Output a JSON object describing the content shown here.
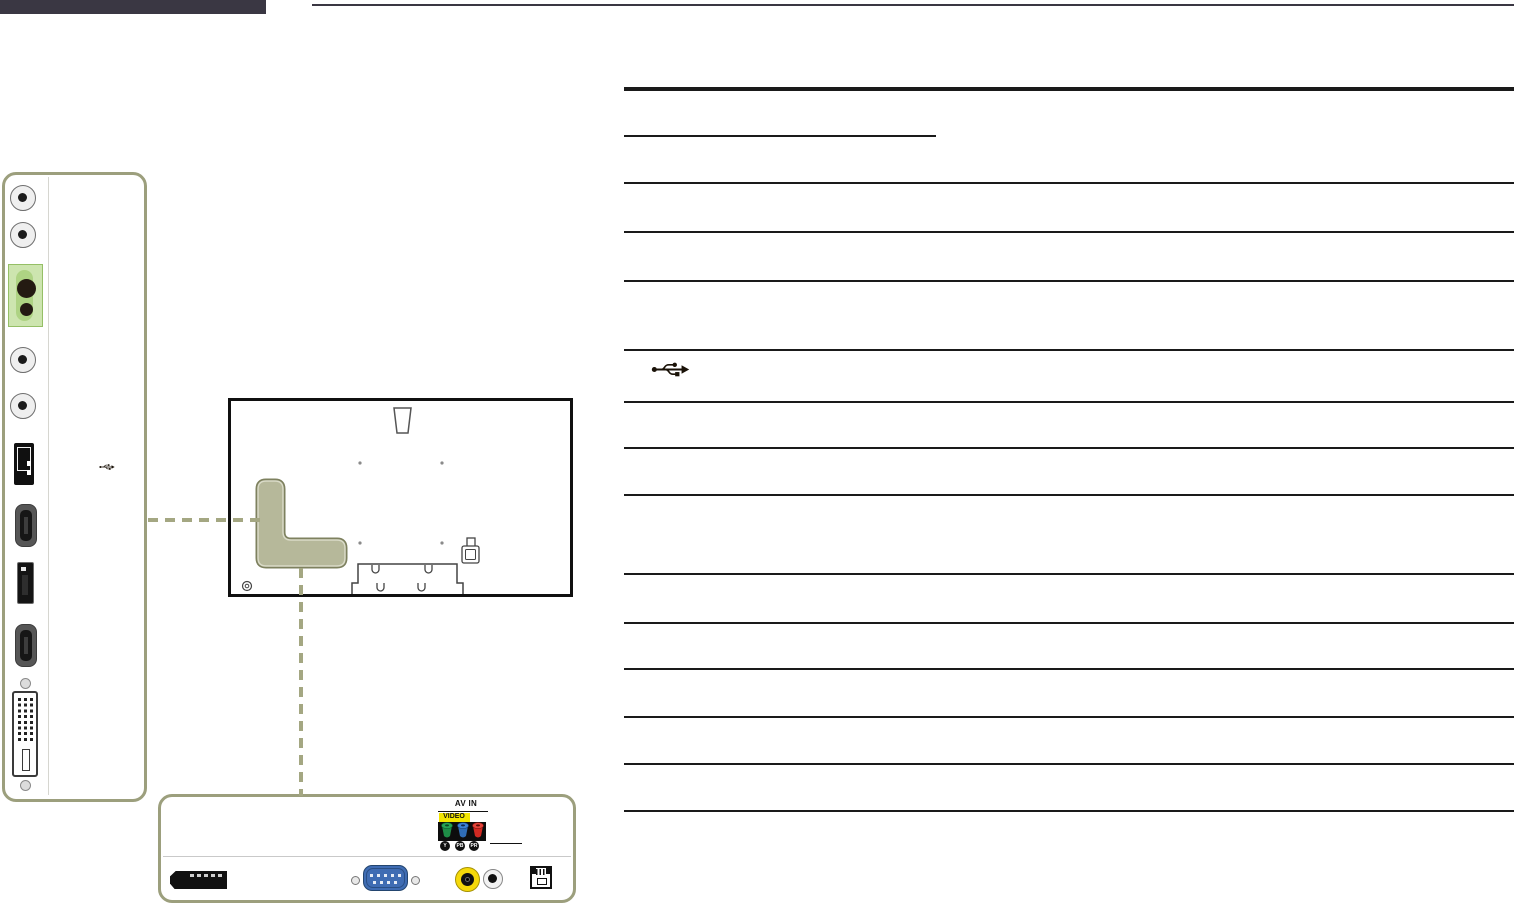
{
  "header": {
    "bar_color": "#3a3743",
    "rule_color": "#3a3743"
  },
  "rear_panel": {
    "outline_color": "#9c9f7d",
    "ports_top_to_bottom": [
      "audio-jack",
      "audio-jack",
      "green-highlight-audio-jacks",
      "audio-jack",
      "audio-jack",
      "usb-port",
      "hdmi-port",
      "displayport",
      "hdmi-port",
      "dvi-port"
    ],
    "highlight_green": {
      "border": "#95bf66",
      "fill": "#cde5af",
      "pill": "#aed383"
    },
    "usb_symbol": "usb-icon"
  },
  "display_back": {
    "outline_color": "#101010",
    "port_area_fill": "#b6b89a",
    "port_area_border": "#7e815f",
    "features": [
      "handle",
      "vesa-holes",
      "port-area-highlight",
      "power-connector",
      "stand-bracket",
      "kensington-lock-slot"
    ]
  },
  "callout": {
    "dash_color": "#a4a782"
  },
  "bottom_panel": {
    "outline_color": "#9c9f7d",
    "av_in_label": "AV IN",
    "video_label": "VIDEO",
    "video_label_bg": "#f2e500",
    "component_labels": [
      "Y",
      "PB",
      "PR"
    ],
    "component_colors": {
      "video_green": "#1e8c46",
      "pb_blue": "#2f6db6",
      "pr_red": "#d02a22"
    },
    "connectors": [
      "dp-out-port",
      "vga-port",
      "rca-video-yellow",
      "rca-audio-white",
      "lan-port"
    ],
    "vga_blue": "#3f6cb3",
    "rca_yellow": "#f5d90a"
  },
  "spec_table": {
    "rule_color": "#1a1a1a",
    "header_rule": "thick",
    "row_separator_count": 13,
    "visible_icons": [
      "usb-icon"
    ]
  }
}
